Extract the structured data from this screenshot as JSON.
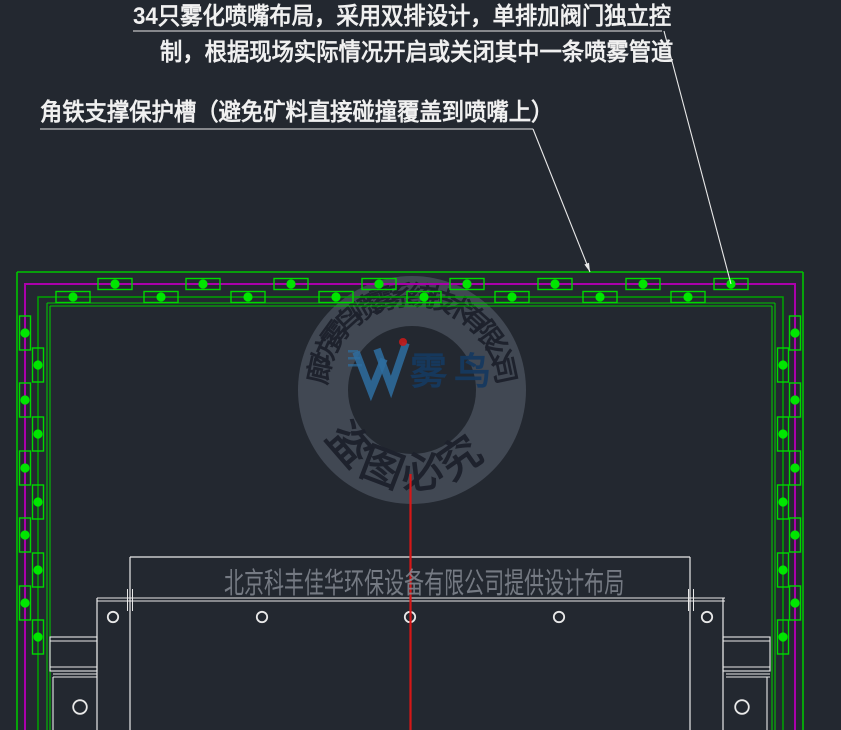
{
  "annotations": {
    "note1_line1": "34只雾化喷嘴布局，采用双排设计，单排加阀门独立控",
    "note1_line2": "制，根据现场实际情况开启或关闭其中一条喷雾管道",
    "note2": "角铁支撑保护槽（避免矿料直接碰撞覆盖到喷嘴上）"
  },
  "watermark": {
    "company_ring": "廊坊雾鸟喷雾系统技术有限公司",
    "seal_text": "盗图必究",
    "logo_text": "雾鸟",
    "design_credit": "北京科丰佳华环保设备有限公司提供设计布局"
  },
  "colors": {
    "bg": "#232830",
    "green_frame": "#00c400",
    "green_pipe": "#00a400",
    "green_nozzle": "#00d800",
    "nozzle_dot": "#00e600",
    "magenta": "#ab00ab",
    "white": "#e9e9e9",
    "red": "#d51717",
    "gray_text": "#8a8f98",
    "ring_fill": "rgba(130,140,160,0.32)",
    "ring_text": "#1d212c",
    "logo_blue": "#2e6da0",
    "logo_dark_blue": "#16395f",
    "logo_red": "#c41b1b"
  },
  "drawing": {
    "frame": {
      "outer_left": 17,
      "outer_top": 272,
      "outer_right": 803,
      "inner_lines_x": [
        47,
        50,
        772,
        775
      ],
      "inner_top_y": [
        303,
        306
      ]
    },
    "pipes": {
      "magenta": {
        "x_left": 25,
        "x_right": 795,
        "y_top": 284
      },
      "green": {
        "x_left": 38,
        "x_right": 783,
        "y_top": 297
      }
    },
    "nozzles": {
      "top_outer_xs": [
        115,
        203,
        291,
        379,
        467,
        555,
        643,
        731
      ],
      "top_inner_xs": [
        73,
        161,
        248,
        336,
        424,
        512,
        600,
        688
      ],
      "side_outer_ys": [
        333,
        400,
        468,
        535,
        603
      ],
      "side_inner_ys": [
        365,
        434,
        502,
        570,
        637
      ]
    },
    "watermark_ring": {
      "cx": 412,
      "cy": 390,
      "r_outer": 114,
      "r_inner": 64,
      "text_r": 94,
      "text_start": -78,
      "text_end": 78,
      "seal_r": 83,
      "seal_angles": [
        -131,
        -159,
        -187,
        -215
      ]
    },
    "equipment": {
      "rect": {
        "left": 130,
        "top": 557,
        "right": 690,
        "bottom": 730
      },
      "band_y": [
        598,
        601
      ],
      "band_x": [
        97,
        725
      ],
      "bracket_left_x": 97,
      "bracket_right_x": 723,
      "bolt_y": 617,
      "bolt_xs": [
        113,
        262,
        410,
        559,
        707
      ],
      "bolt_r": 5.2,
      "boxes": [
        [
          50,
          637,
          47,
          34
        ],
        [
          723,
          637,
          47,
          34
        ]
      ],
      "lower_circles": [
        [
          80,
          707
        ],
        [
          742,
          707
        ]
      ],
      "lower_circle_r": 6.8
    },
    "red_line": {
      "x": 410.5,
      "y1": 474,
      "y2": 730
    },
    "underlines": [
      [
        133,
        31,
        662
      ],
      [
        40,
        129,
        533
      ]
    ],
    "leaders": [
      [
        664,
        31,
        731,
        284
      ],
      [
        533,
        129,
        590,
        272
      ]
    ]
  }
}
